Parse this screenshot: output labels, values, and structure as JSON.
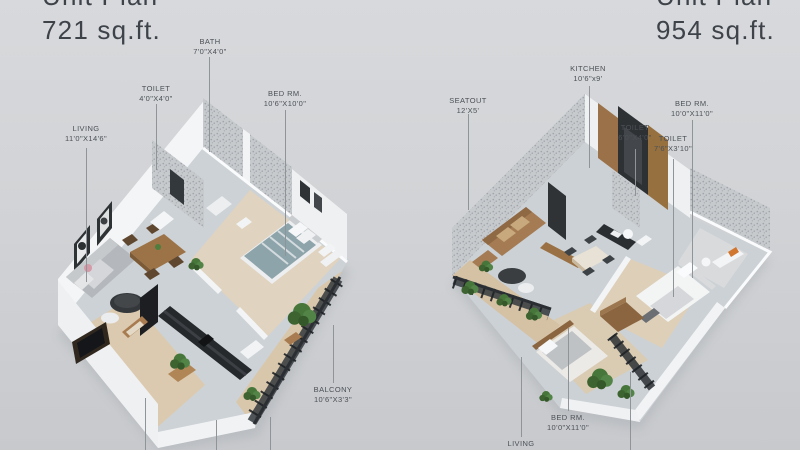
{
  "page": {
    "description": "Two isometric 3D floor plan renders side by side on a gray background",
    "background_top": "#d7d9dc",
    "background_bottom": "#c7c9cd"
  },
  "left_unit": {
    "title_line1": "Unit Plan",
    "title_line2": "721 sq.ft.",
    "labels": {
      "living": {
        "name": "LIVING",
        "dims": "11'0\"X14'6\""
      },
      "toilet": {
        "name": "TOILET",
        "dims": "4'0\"X4'0\""
      },
      "bath": {
        "name": "BATH",
        "dims": "7'0\"X4'0\""
      },
      "bedroom": {
        "name": "BED RM.",
        "dims": "10'6\"X10'0\""
      },
      "balcony": {
        "name": "BALCONY",
        "dims": "10'6\"X3'3\""
      }
    }
  },
  "right_unit": {
    "title_line1": "Unit Plan",
    "title_line2": "954 sq.ft.",
    "labels": {
      "seatout": {
        "name": "SEATOUT",
        "dims": "12'X5'"
      },
      "kitchen": {
        "name": "KITCHEN",
        "dims": "10'6\"x9'"
      },
      "toilet1": {
        "name": "TOILET",
        "dims": "6'0\"X4'0\""
      },
      "toilet2": {
        "name": "TOILET",
        "dims": "7'6\"X3'10\""
      },
      "bedroom1": {
        "name": "BED RM.",
        "dims": "10'0\"X11'0\""
      },
      "bedroom2": {
        "name": "BED RM.",
        "dims": "10'0\"X11'0\""
      },
      "living": {
        "name": "LIVING",
        "dims": ""
      }
    }
  },
  "colors": {
    "title_text": "#3e434a",
    "label_text": "#4c5157",
    "leader_line": "#8f9499",
    "floor_gray": "#cdd2d6",
    "floor_wood": "#ddcfba",
    "wall_white": "#f4f5f6",
    "terrazzo_wall": "#c7cacd",
    "wood_furniture": "#9c7347",
    "kitchen_counter_dark": "#26292c",
    "sofa_gray": "#b4b8bc",
    "sofa_brown": "#a57b53",
    "bed_teal": "#8da4ab",
    "railing_dark": "#2b2f33",
    "plant_green": "#47763a",
    "accent_orange": "#d0762e"
  }
}
